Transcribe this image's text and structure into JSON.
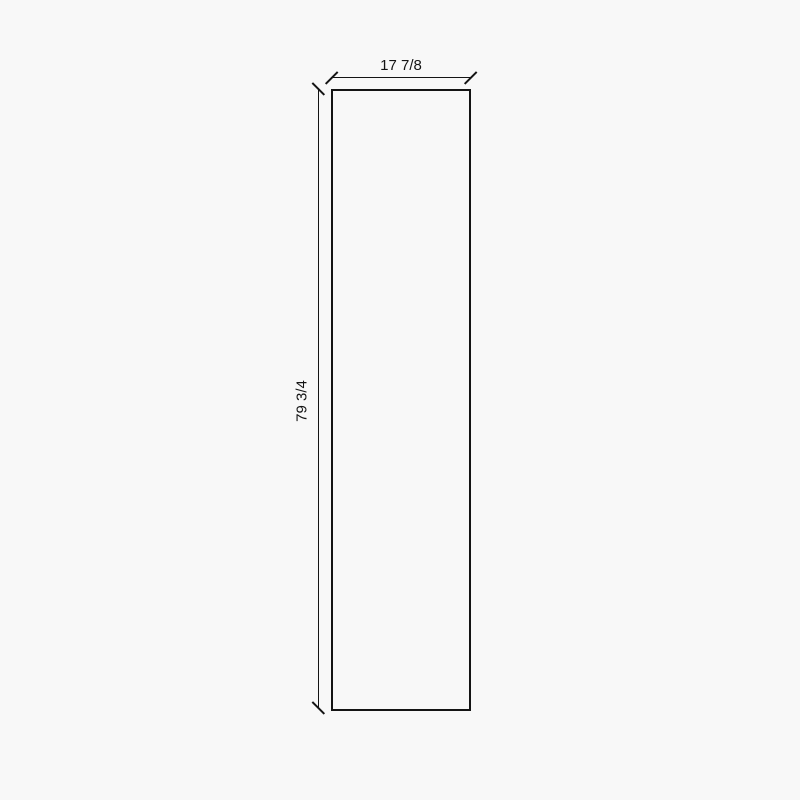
{
  "drawing": {
    "type": "panel-dimension-diagram",
    "panel": {
      "width_label": "17 7/8",
      "height_label": "79 3/4"
    }
  },
  "colors": {
    "background": "#f8f8f8",
    "line": "#141414",
    "text": "#141414"
  }
}
